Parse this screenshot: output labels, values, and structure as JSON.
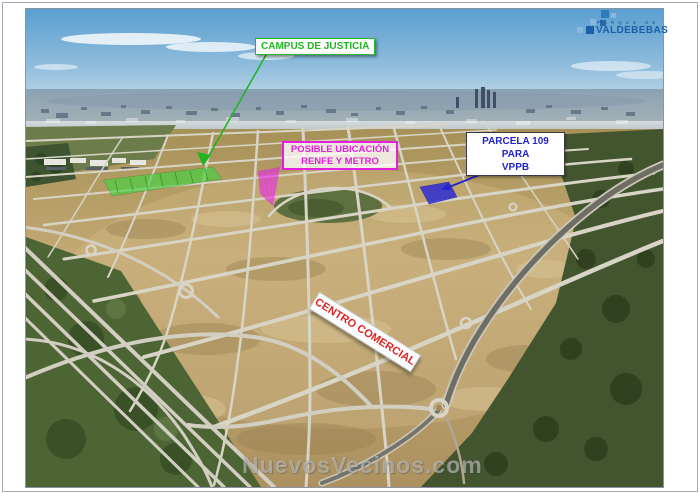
{
  "page": {
    "background_color": "#ffffff",
    "frame_color": "#a8a8b2",
    "description": "Aerial photograph of the Valdebebas development area with annotated parcels"
  },
  "logo": {
    "tagline": "PARQUE DE",
    "name": "VALDEBEBAS",
    "color_primary": "#1d5fa6",
    "color_light": "#8ab8dc"
  },
  "annotations": {
    "campus": {
      "label": "CAMPUS DE JUSTICIA",
      "text_color": "#22b422",
      "area_color": "#3fd53f"
    },
    "renfe": {
      "line1": "POSIBLE UBICACIÓN",
      "line2": "RENFE Y METRO",
      "text_color": "#e41ede",
      "area_color": "#e61ee6"
    },
    "parcela109": {
      "line1": "PARCELA 109 PARA",
      "line2": "VPPB",
      "text_color": "#2525cc",
      "area_color": "#2d2dd2"
    },
    "centro": {
      "label": "CENTRO COMERCIAL",
      "text_color": "#e02222"
    }
  },
  "watermark": {
    "text": "NuevosVecinos.com"
  }
}
